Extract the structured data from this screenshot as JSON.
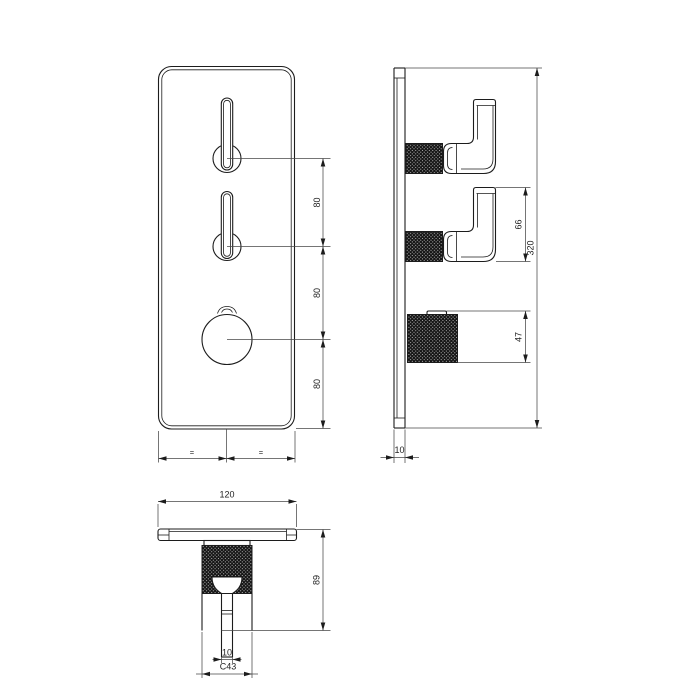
{
  "drawing": {
    "title": "thermostatic shower valve trim - dimensional drawing",
    "colors": {
      "line": "#1c1c1c",
      "dimension": "#474747",
      "background": "#ffffff",
      "knurl_fill": "#141414"
    }
  },
  "views": {
    "front": {
      "name": "front view",
      "dims": {
        "pitch_top": "80",
        "pitch_mid": "80",
        "pitch_bottom": "80",
        "equal_left": "=",
        "equal_right": "="
      }
    },
    "side": {
      "name": "side view",
      "dims": {
        "handle_height": "66",
        "knob_depth": "47",
        "plate_height": "320",
        "plate_thickness": "10"
      }
    },
    "bottom": {
      "name": "bottom view",
      "dims": {
        "plate_width": "120",
        "lever_tip_width": "10",
        "knob_diameter": "C43",
        "projection": "89"
      }
    }
  }
}
